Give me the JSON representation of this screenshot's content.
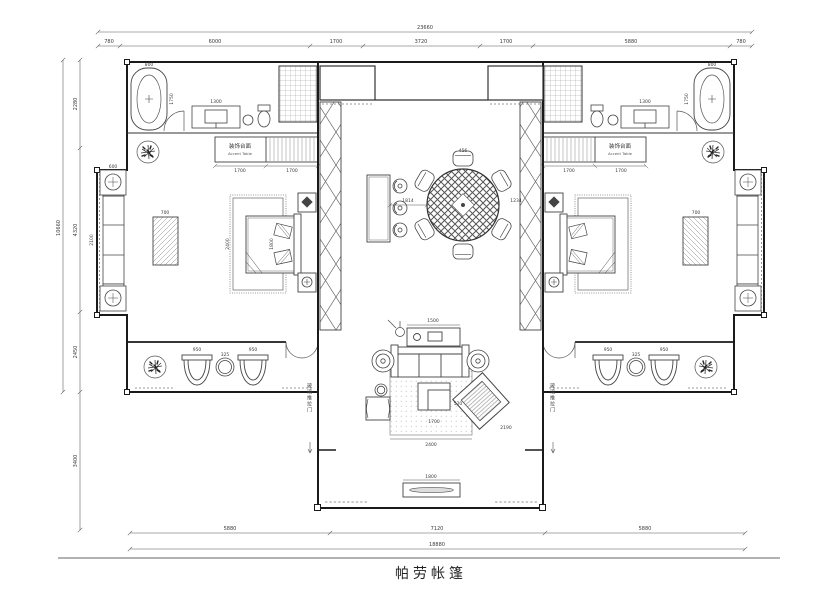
{
  "title": "帕劳帐篷",
  "dims": {
    "top": {
      "total": "23660",
      "segments": [
        "780",
        "6000",
        "1700",
        "3720",
        "1700",
        "5880",
        "780"
      ]
    },
    "left": {
      "total": "10660",
      "segments": [
        "2280",
        "4320",
        "2450",
        "3400"
      ]
    },
    "bottom": {
      "total": "18880",
      "segments": [
        "5880",
        "7120",
        "5880"
      ]
    }
  },
  "labels": {
    "accent_cn": "装饰台面",
    "accent_en": "Accent Table",
    "sliding_door": "玻璃推拉门"
  },
  "left_wing": {
    "tub_w": "800",
    "tub_l": "1750",
    "vanity": "1300",
    "cab_a": "1700",
    "cab_b": "1700",
    "table": "700",
    "sofa": "2100",
    "end_table": "600",
    "bed_w": "1800",
    "bed_l": "2400",
    "chair_a": "950",
    "deck_table": "325",
    "chair_b": "950"
  },
  "right_wing": {
    "tub_w": "800",
    "tub_l": "1750",
    "vanity": "1300",
    "cab_a": "1700",
    "cab_b": "1700",
    "table": "700",
    "chair_a": "950",
    "deck_table": "325",
    "chair_b": "950"
  },
  "center": {
    "chair": "456",
    "bar_gap": "1814",
    "table_side": "1234",
    "console": "1500",
    "rug": "2400",
    "rug_side": "2190",
    "coffee_w": "520",
    "coffee_l": "1700",
    "planter": "1800"
  }
}
